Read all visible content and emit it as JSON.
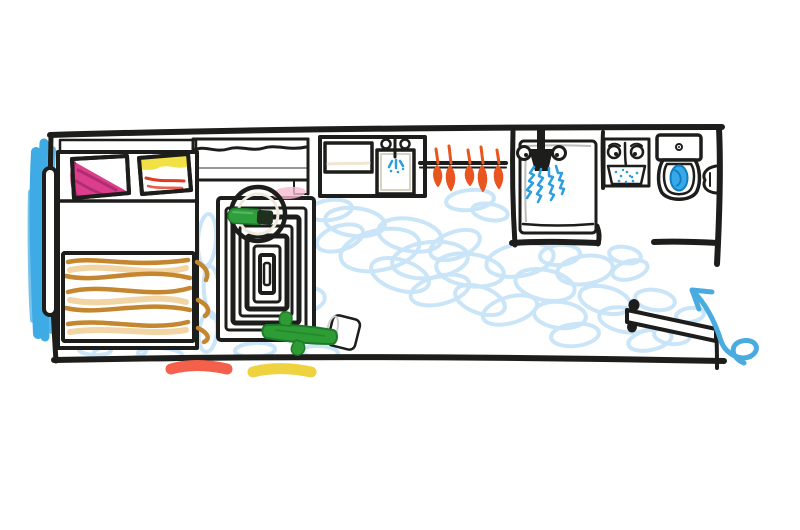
{
  "scene": {
    "title": "Hand-drawn studio apartment floor plan sketch",
    "items": [
      "balcony-window-light",
      "sliding-door",
      "bed",
      "pillow-diagonal-pink-yellow",
      "pillow-orange-yellow",
      "duvet",
      "headboard-shelf",
      "curtain-window",
      "concentric-rug",
      "round-side-table",
      "green-bottle",
      "cactus-in-basket-pot",
      "kitchen-counter",
      "cutting-board",
      "kitchen-sink",
      "wardrobe-rail-with-hangers",
      "shower-stall",
      "shower-head",
      "bathroom-sink",
      "toilet",
      "toilet-paper-holder",
      "entry-door-open",
      "entrance-arrow",
      "doormat-red",
      "doormat-yellow",
      "floor-scribbles"
    ]
  },
  "colors": {
    "paper": "#ffffff",
    "ink": "#1d1d1b",
    "floor_scribble": "#c9e5f7",
    "balcony_blue": "#3fabe4",
    "hatch_line": "#78aecf",
    "hatch_bg": "#eef6fc",
    "arrow_blue": "#49abe0",
    "water_blue": "#2b9de0",
    "toilet_water": "#38a9e8",
    "toilet_water_dark": "#0f7ec0",
    "spray_blue": "#2d9fe0",
    "blanket": "#daa147",
    "blanket_stroke": "#c4862e",
    "blanket_light": "#e7b968",
    "pillow_yellow": "#f2e144",
    "pillow_pink": "#dd3d8d",
    "pillow_pink_dark": "#b02e6f",
    "pillow_orange": "#f4593a",
    "pillow_orange_stroke": "#e03a22",
    "hanger_orange": "#e8551e",
    "counter_tan": "#d5cab2",
    "board_tan": "#cbbfa1",
    "board_line": "#efe7d3",
    "table_tan": "#d9cfbb",
    "table_inner": "#efe9dc",
    "bottle_green": "#2f9e3c",
    "bottle_cap": "#20301f",
    "cactus_green": "#2e9c35",
    "cactus_dark": "#1d7a28",
    "pot_black": "#242422",
    "pot_dot": "#ffffff",
    "mat_red": "#f4604a",
    "mat_yellow": "#eed23f",
    "pink_smudge": "#f6bcd2",
    "sketch_grey": "#bdbdbd"
  }
}
